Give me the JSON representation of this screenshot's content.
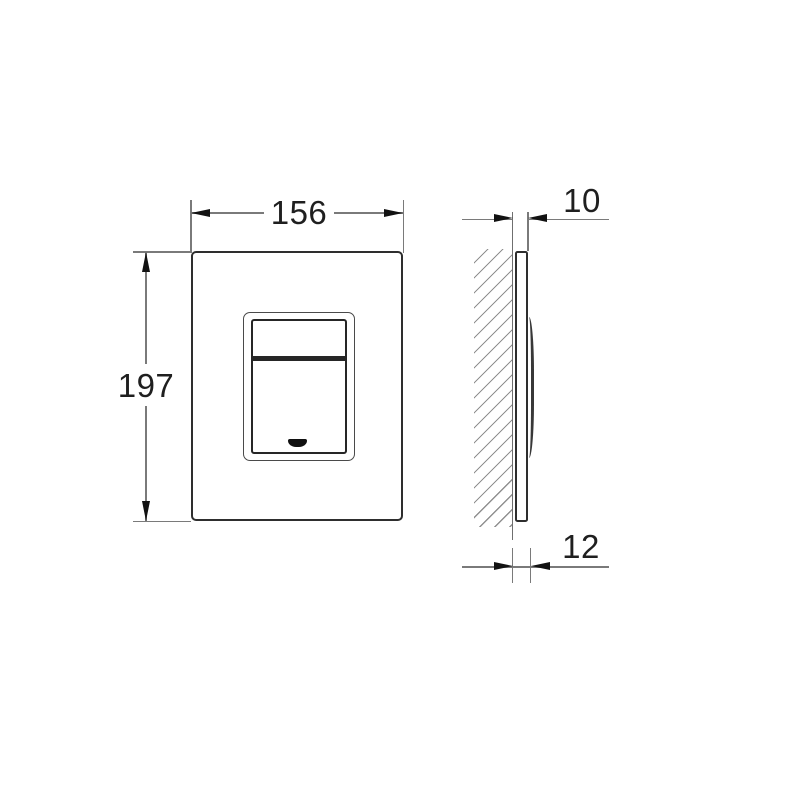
{
  "drawing": {
    "type": "technical-dimension-drawing",
    "subject": "wall-mounted flush plate, front view and side view",
    "front_view": {
      "width_dim": "156",
      "height_dim": "197"
    },
    "side_view": {
      "thickness_dim": "10",
      "depth_dim": "12"
    },
    "colors": {
      "background": "#ffffff",
      "object_line": "#2e2e2e",
      "dimension_line": "#7a7a7a",
      "arrow_and_text": "#121212",
      "hatch_line": "#909090"
    }
  }
}
